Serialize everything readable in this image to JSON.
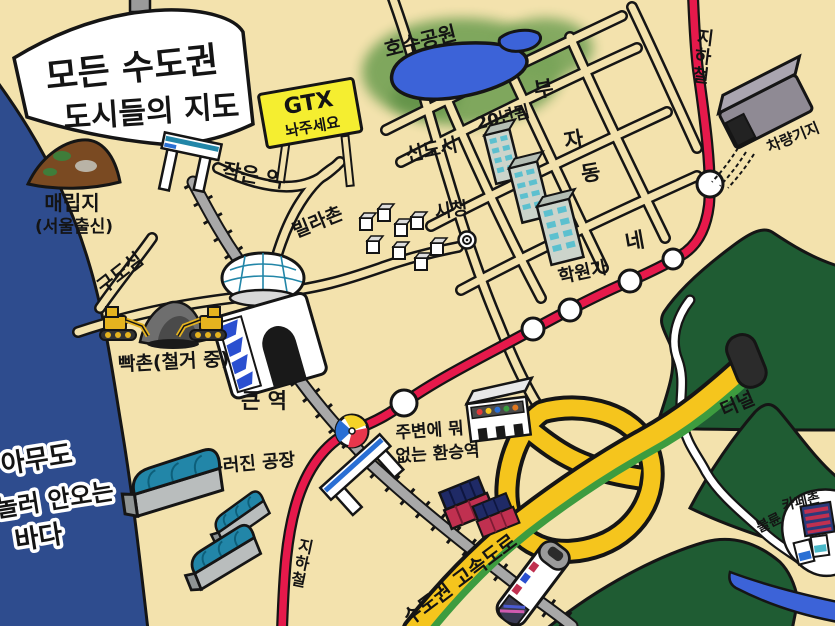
{
  "map_title_line1": "모든  수도권",
  "map_title_line2": "도시들의 지도",
  "labels": {
    "landfill": "매립지",
    "landfill_sub": "(서울출신)",
    "small_station": "작은 역",
    "gtx1": "GTX",
    "gtx2": "놔주세요",
    "lake_park": "호수공원",
    "new_town": "신도시",
    "aged": "20년됨",
    "rich": [
      "부",
      "자",
      "동",
      "네"
    ],
    "city_hall": "시청",
    "academy": "학원가",
    "subway_top": "지하철",
    "subway_bottom": "지하철",
    "depot": "차량기지",
    "villa": "빌라촌",
    "old_town": "구도심",
    "demolition": "빡촌(철거 중)",
    "big_station": "큰 역",
    "transfer1": "주변에 뭐",
    "transfer2": "없는 환승역",
    "sea1": "아무도",
    "sea2": "놀러 안오는",
    "sea3": "바다",
    "factory": "널부러진 공장",
    "highway": "수도권 고속도로",
    "tunnel": "터널",
    "cafe": "카페촌",
    "affair": "불륜"
  },
  "colors": {
    "background": "#f3e2ad",
    "sea": "#2e4c8e",
    "lake": "#3c63d8",
    "park_green": "#79a459",
    "mountain": "#1f5c33",
    "line_red": "#e6194b",
    "highway_yellow": "#f5c51d",
    "highway_green": "#3d9c3f",
    "gtx_yellow": "#f5ee30",
    "rail_gray": "#a8a8a8",
    "mound_brown": "#7a4a22",
    "roof_teal": "#2286a8",
    "ball_blue": "#2a6fd4",
    "ball_yellow": "#f5d327",
    "ball_red": "#e8364c"
  }
}
